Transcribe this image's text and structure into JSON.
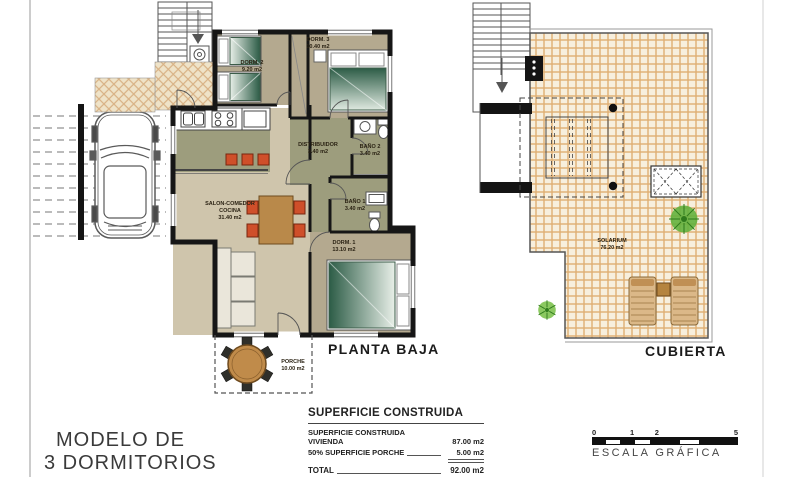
{
  "sheet": {
    "model": {
      "line1": "MODELO DE",
      "line2": "3 DORMITORIOS"
    }
  },
  "planta_baja": {
    "caption": "PLANTA BAJA",
    "rooms": [
      {
        "name": "DORM. 2",
        "area": "9.20 m2"
      },
      {
        "name": "DORM. 3",
        "area": "10.40 m2"
      },
      {
        "name": "DISTRIBUIDOR",
        "area": "3.40 m2"
      },
      {
        "name": "BAÑO 2",
        "area": "3.40 m2"
      },
      {
        "name": "BAÑO 1",
        "area": "3.40 m2"
      },
      {
        "name": "SALON-COMEDOR",
        "name2": "COCINA",
        "area": "31.40 m2"
      },
      {
        "name": "DORM. 1",
        "area": "13.10 m2"
      },
      {
        "name": "PORCHE",
        "area": "10.00 m2"
      }
    ]
  },
  "cubierta": {
    "caption": "CUBIERTA",
    "solarium": {
      "name": "SOLARIUM",
      "area": "76.20 m2"
    }
  },
  "summary": {
    "title": "SUPERFICIE CONSTRUIDA",
    "rows": [
      {
        "label": "SUPERFICIE CONSTRUIDA VIVIENDA",
        "value": "87.00 m2"
      },
      {
        "label": "50% SUPERFICIE PORCHE",
        "value": "5.00 m2"
      }
    ],
    "total_label": "TOTAL",
    "total_value": "92.00 m2"
  },
  "scale_bar": {
    "ticks": [
      "0",
      "1",
      "2",
      "5"
    ],
    "label": "ESCALA GRÁFICA"
  },
  "colors": {
    "wall": "#161616",
    "floor_bedroom": "#b4a98f",
    "floor_wet": "#9d9d7d",
    "floor_salon": "#cfc5ac",
    "tile_grout": "#dfae72",
    "tile_fill": "#f7efdd",
    "bed_green": "#2c5c46",
    "chair_red": "#cf4f2a",
    "wood": "#b9894a",
    "plant_green": "#63b13d"
  }
}
